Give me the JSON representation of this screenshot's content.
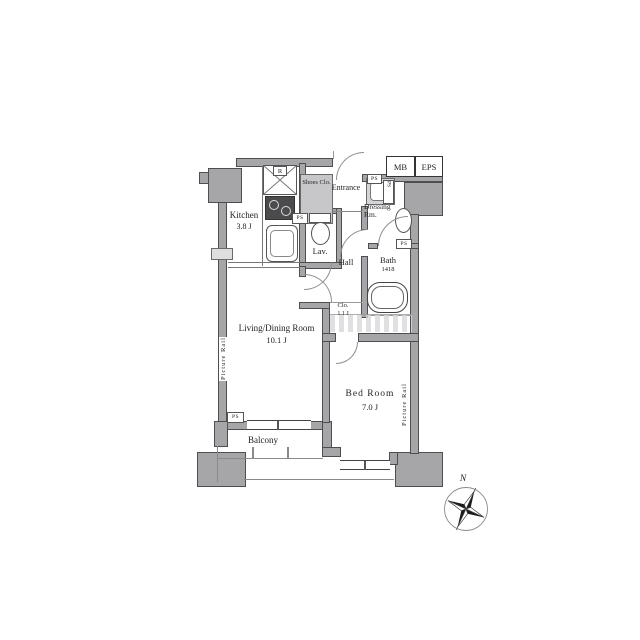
{
  "plan": {
    "rooms": {
      "kitchen": {
        "name": "Kitchen",
        "area": "3.8 J"
      },
      "living": {
        "name": "Living/Dining Room",
        "area": "10.1 J"
      },
      "bedroom": {
        "name": "Bed Room",
        "area": "7.0 J"
      },
      "balcony": {
        "name": "Balcony"
      },
      "hall": {
        "name": "Hall"
      },
      "lavatory": {
        "name": "Lav."
      },
      "bath": {
        "name": "Bath",
        "size": "1418"
      },
      "dressing": {
        "name": "Dressing Rm."
      },
      "entrance": {
        "name": "Entrance"
      },
      "shoes_closet": {
        "name": "Shoes Clo."
      },
      "closet": {
        "name": "Clo.",
        "area": "1.1 J"
      }
    },
    "shafts": {
      "mb": "MB",
      "eps": "EPS",
      "ps": "PS"
    },
    "fixtures": {
      "refrigerator": "R"
    },
    "annotations": {
      "picture_rail": "Picture Rail",
      "north": "N"
    },
    "colors": {
      "background": "#ffffff",
      "wall_fill": "#a6a6a8",
      "wall_border": "#4e4e52",
      "shade_fill": "#c7c7c9",
      "text": "#222222"
    }
  }
}
